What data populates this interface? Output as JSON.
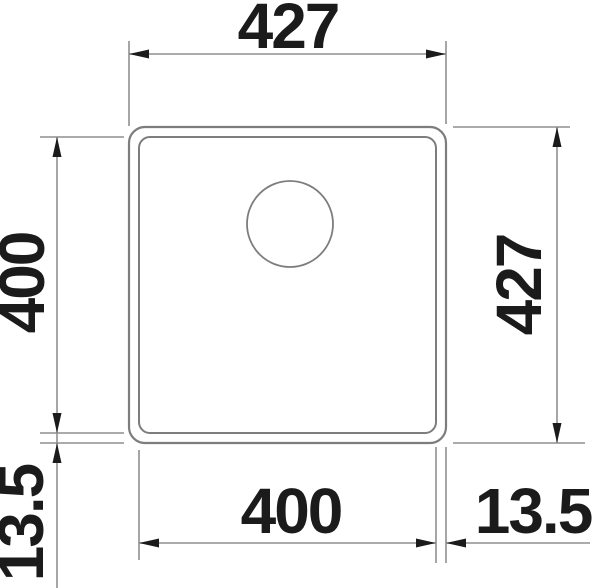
{
  "diagram": {
    "type": "technical-drawing",
    "subject": "square-sink-top-view-dimensions",
    "labels": {
      "outer_width_mm": "427",
      "outer_depth_mm": "427",
      "bowl_depth_mm": "400",
      "bowl_width_mm": "400",
      "rim_bottom_left_mm": "13.5",
      "rim_bottom_right_mm": "13.5"
    },
    "colors": {
      "background": "#ffffff",
      "outline": "#7d7d7d",
      "dimension_lines": "#8f8f8f",
      "ink": "#1b1b1b"
    }
  }
}
